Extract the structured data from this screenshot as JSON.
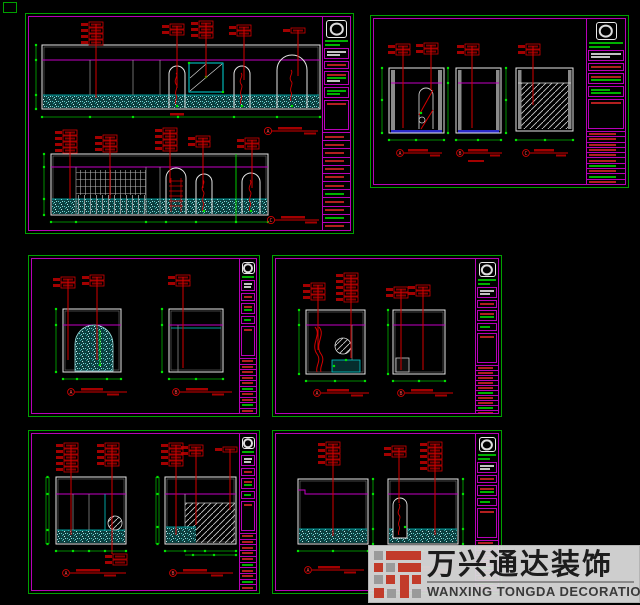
{
  "watermark": {
    "company_cn": "万兴通达装饰",
    "company_en": "WANXING TONGDA DECORATION",
    "bg_color": "#d9d9d9",
    "brand_red": "#c23b2a",
    "brand_gray": "#9a9a9a"
  },
  "colors": {
    "background": "#000000",
    "panel_border_green": "#00a000",
    "panel_border_magenta": "#b800b8",
    "dimension_green": "#00c400",
    "annotation_red": "#d40000",
    "outline_white": "#e6e6e6",
    "hatch_cyan": "#00caca"
  },
  "panels": {
    "tl": {
      "tags": [
        "A",
        "C"
      ]
    },
    "tr": {
      "tags": [
        "A",
        "B",
        "C"
      ]
    },
    "ml": {
      "tags": [
        "A",
        "B"
      ]
    },
    "mr": {
      "tags": [
        "A",
        "B"
      ]
    },
    "bl": {
      "tags": [
        "A",
        "B"
      ]
    },
    "br": {
      "tags": [
        "A",
        "B"
      ]
    }
  }
}
